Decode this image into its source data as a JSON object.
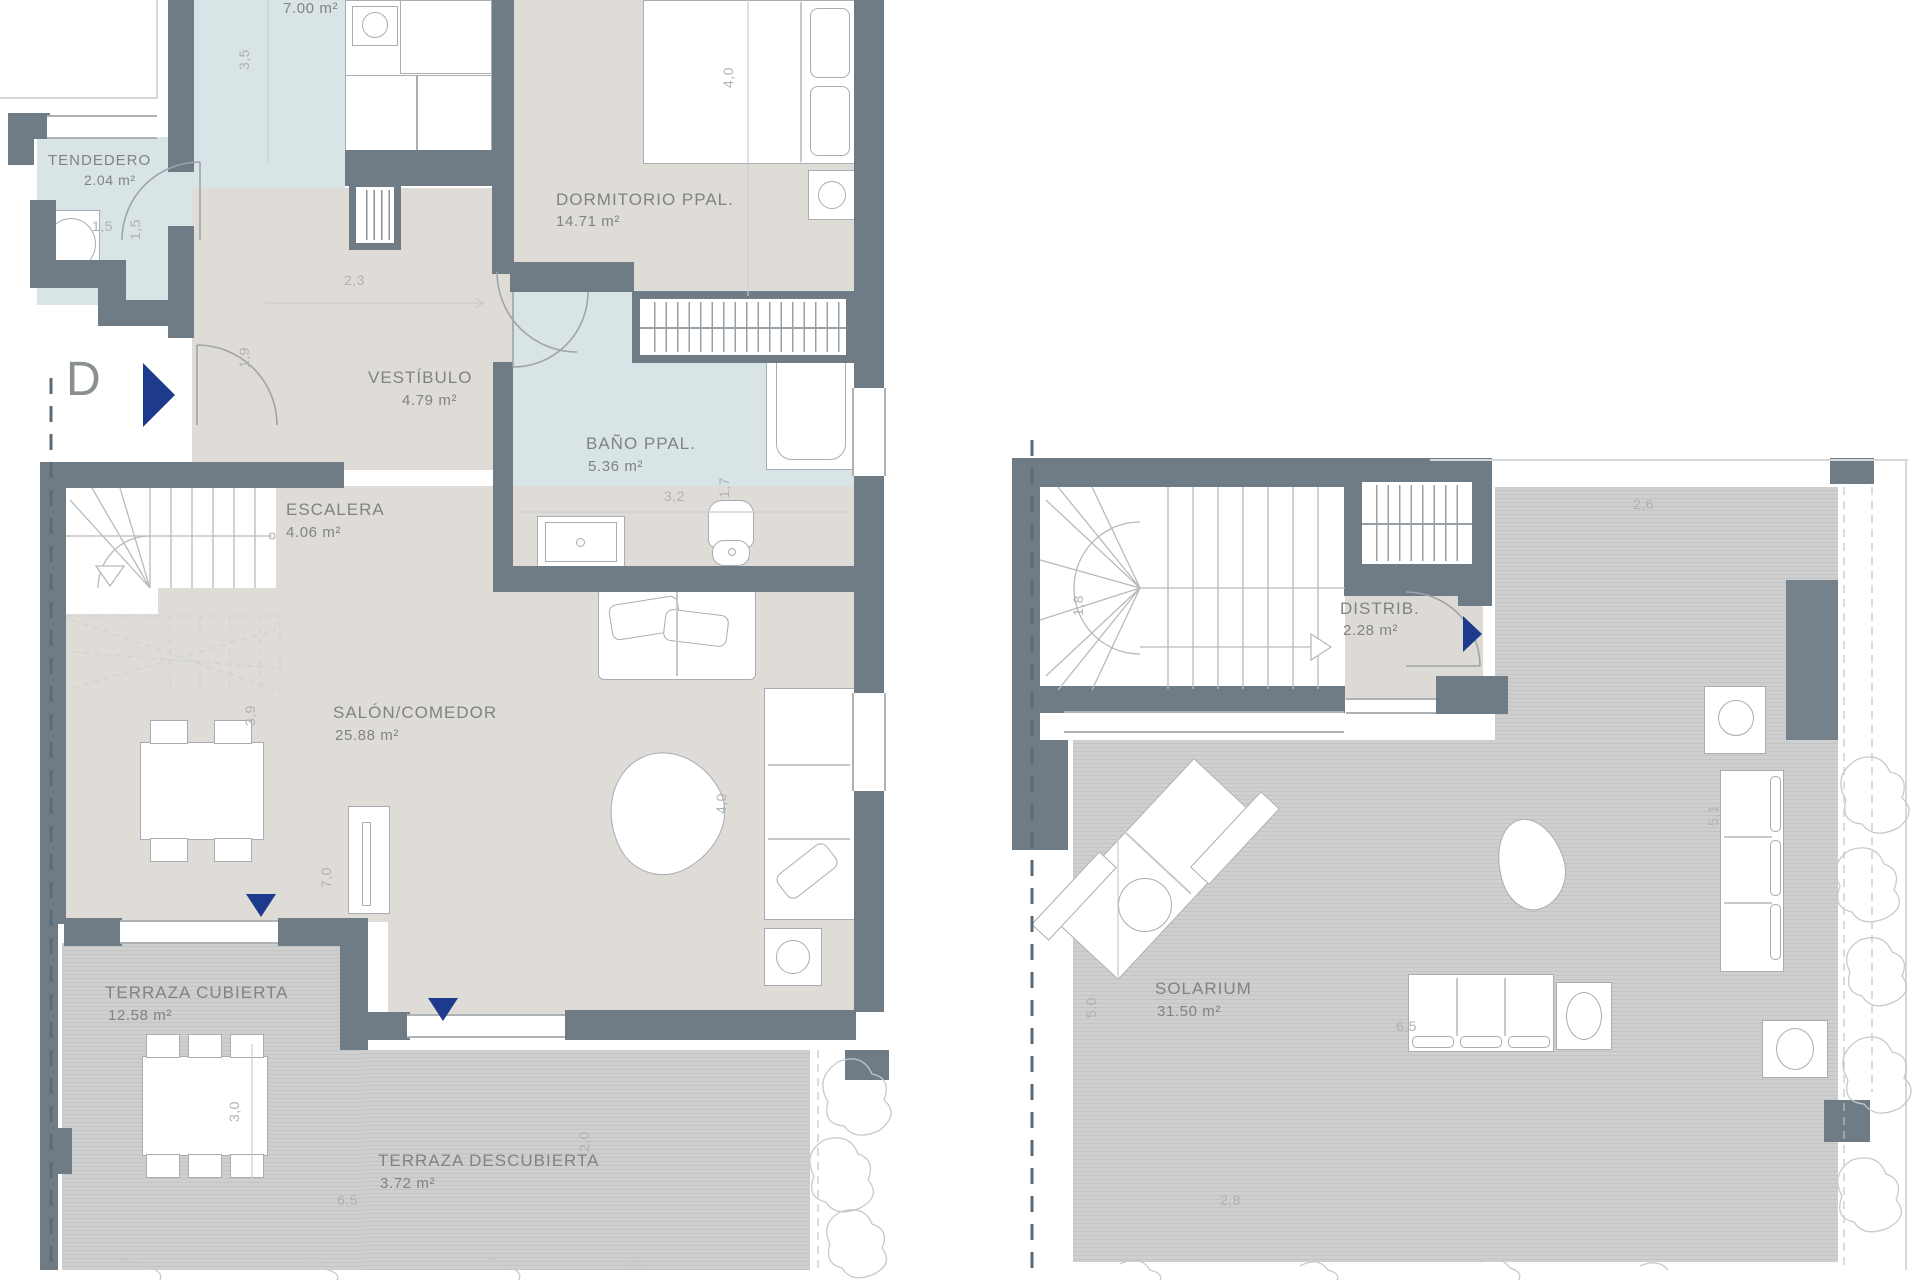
{
  "title": "Duplex penthouse floor plan — unit D",
  "unit": {
    "letter": "D"
  },
  "colors": {
    "wall": "#6F7B85",
    "wet_room_fill": "#D9E4E7",
    "interior_fill": "#DFDCD7",
    "deck_fill": "#CDCDCD",
    "accent_arrow": "#1D3A8C",
    "label_text": "#7E8386",
    "dim_text": "#AFB2B4"
  },
  "floor_main": {
    "rooms": {
      "cocina": {
        "name": "",
        "area": "7.00 m²"
      },
      "tendedero": {
        "name": "TENDEDERO",
        "area": "2.04 m²"
      },
      "dormitorio": {
        "name": "DORMITORIO PPAL.",
        "area": "14.71 m²"
      },
      "vestibulo": {
        "name": "VESTÍBULO",
        "area": "4.79 m²"
      },
      "bano": {
        "name": "BAÑO PPAL.",
        "area": "5.36 m²"
      },
      "escalera": {
        "name": "ESCALERA",
        "area": "4.06 m²"
      },
      "salon": {
        "name": "SALÓN/COMEDOR",
        "area": "25.88 m²"
      },
      "terraza_cubierta": {
        "name": "TERRAZA CUBIERTA",
        "area": "12.58 m²"
      },
      "terraza_descubierta": {
        "name": "TERRAZA DESCUBIERTA",
        "area": "3.72 m²"
      }
    },
    "dims": {
      "k35": "3,5",
      "k15a": "1,5",
      "k15b": "1,5",
      "k23": "2,3",
      "k19": "1,9",
      "k40dorm": "4,0",
      "k32": "3,2",
      "k17": "1,7",
      "k39": "3,9",
      "k70": "7,0",
      "k40salon": "4,0",
      "k30": "3,0",
      "k65": "6,5",
      "k20": "2,0"
    }
  },
  "floor_solarium": {
    "rooms": {
      "distrib": {
        "name": "DISTRIB.",
        "area": "2.28 m²"
      },
      "solarium": {
        "name": "SOLARIUM",
        "area": "31.50 m²"
      }
    },
    "dims": {
      "k18": "1,8",
      "k26": "2,6",
      "k50": "5,0",
      "k51": "5,1",
      "k65": "6,5",
      "k28": "2,8"
    }
  }
}
